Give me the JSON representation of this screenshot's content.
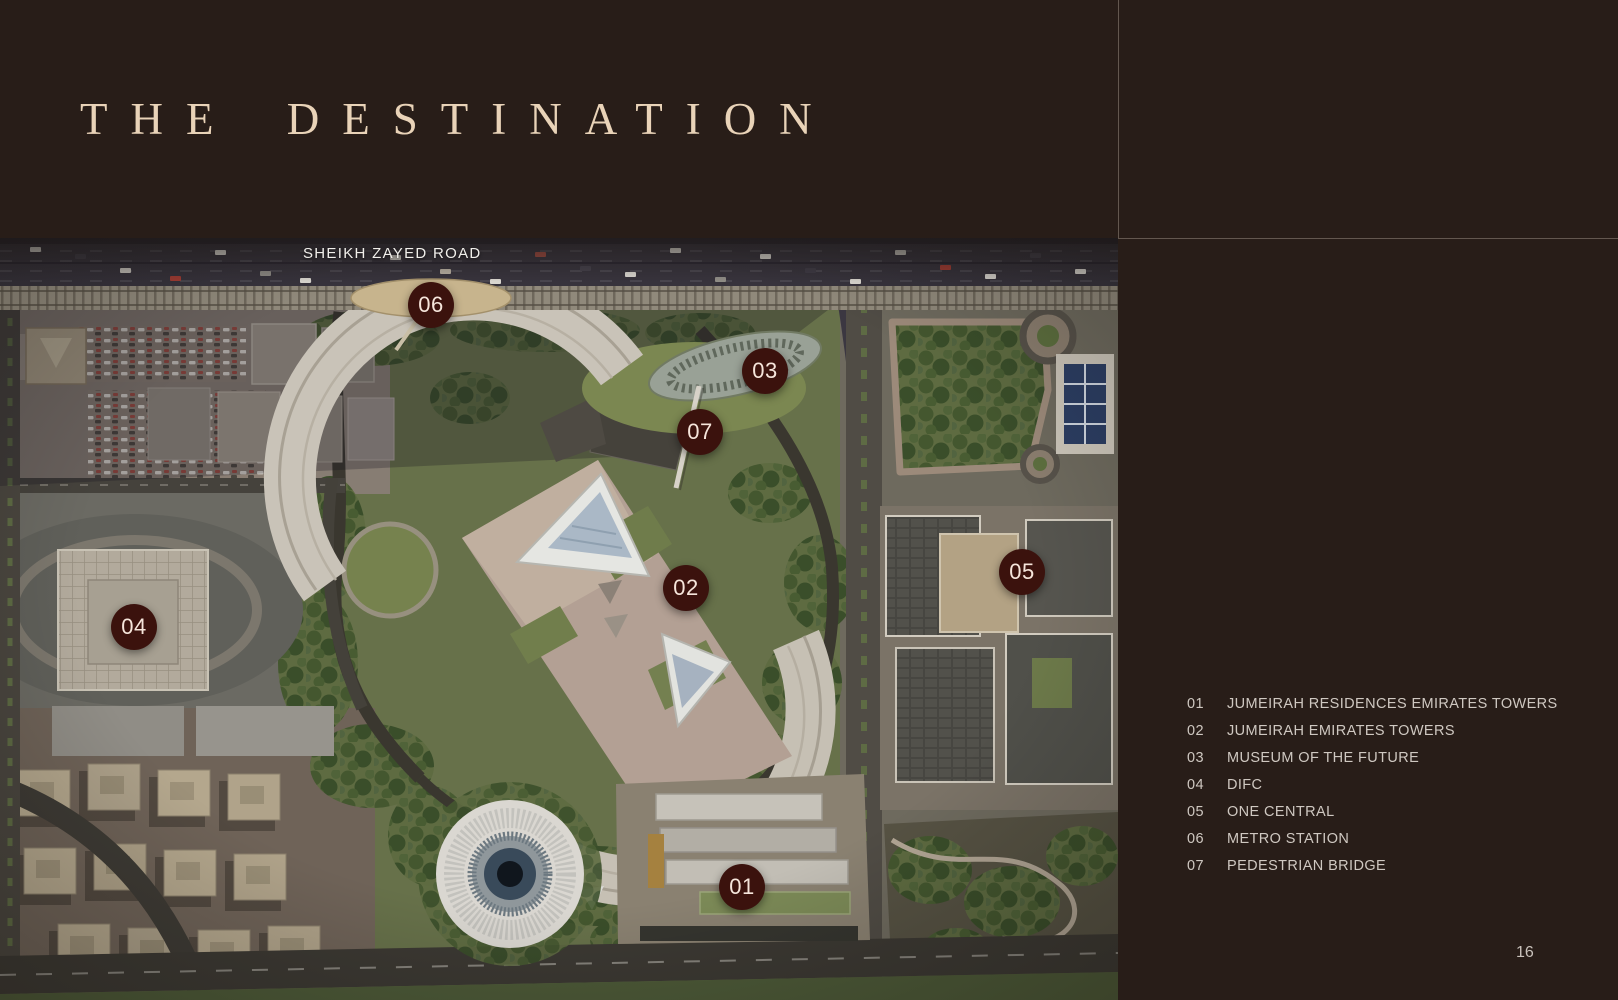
{
  "page": {
    "page_number": "16"
  },
  "header": {
    "title": "THE DESTINATION"
  },
  "colors": {
    "background": "#281d18",
    "title_text": "#e9d3b8",
    "legend_text": "#cfc8c1",
    "marker_bg": "#3b120d",
    "marker_text": "#f6e5db"
  },
  "map": {
    "road_label": "SHEIKH ZAYED ROAD",
    "markers": [
      {
        "id": "01",
        "x": 742,
        "y": 887
      },
      {
        "id": "02",
        "x": 686,
        "y": 588
      },
      {
        "id": "03",
        "x": 765,
        "y": 371
      },
      {
        "id": "04",
        "x": 134,
        "y": 627
      },
      {
        "id": "05",
        "x": 1022,
        "y": 572
      },
      {
        "id": "06",
        "x": 431,
        "y": 305
      },
      {
        "id": "07",
        "x": 700,
        "y": 432
      }
    ]
  },
  "legend": {
    "items": [
      {
        "number": "01",
        "label": "JUMEIRAH RESIDENCES EMIRATES TOWERS"
      },
      {
        "number": "02",
        "label": "JUMEIRAH EMIRATES TOWERS"
      },
      {
        "number": "03",
        "label": "MUSEUM OF THE FUTURE"
      },
      {
        "number": "04",
        "label": "DIFC"
      },
      {
        "number": "05",
        "label": "ONE CENTRAL"
      },
      {
        "number": "06",
        "label": "METRO STATION"
      },
      {
        "number": "07",
        "label": "PEDESTRIAN BRIDGE"
      }
    ]
  }
}
